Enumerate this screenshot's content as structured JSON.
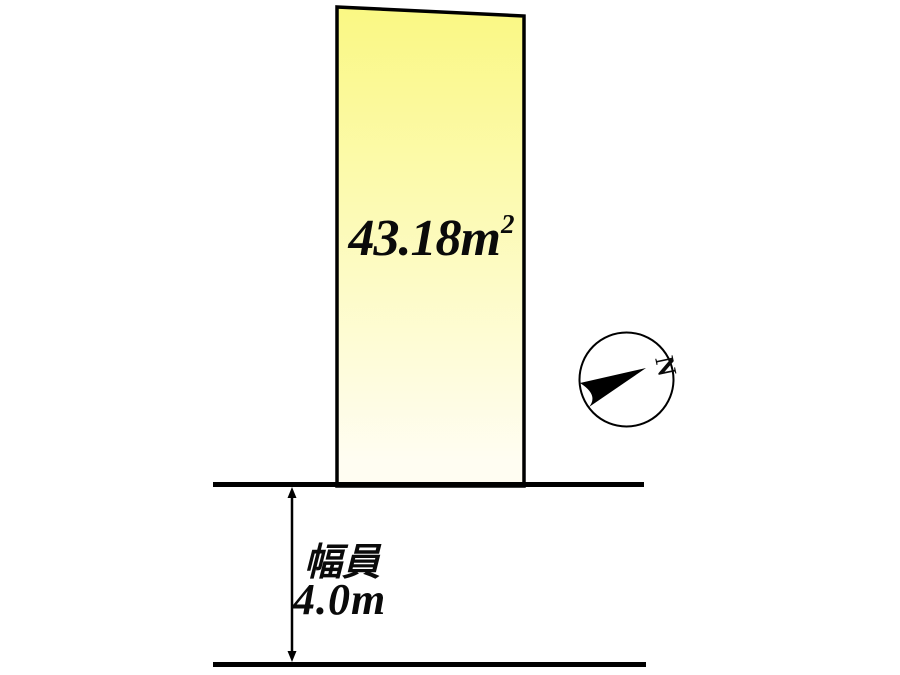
{
  "plot": {
    "area_value": "43.18m",
    "area_exponent": "2"
  },
  "road": {
    "width_label": "幅員",
    "width_value": "4.0m"
  },
  "compass": {
    "north": "N"
  },
  "colors": {
    "plot_fill_top": "#faf883",
    "plot_fill_bottom": "#fffdf2",
    "line": "#000000",
    "background": "#ffffff"
  }
}
